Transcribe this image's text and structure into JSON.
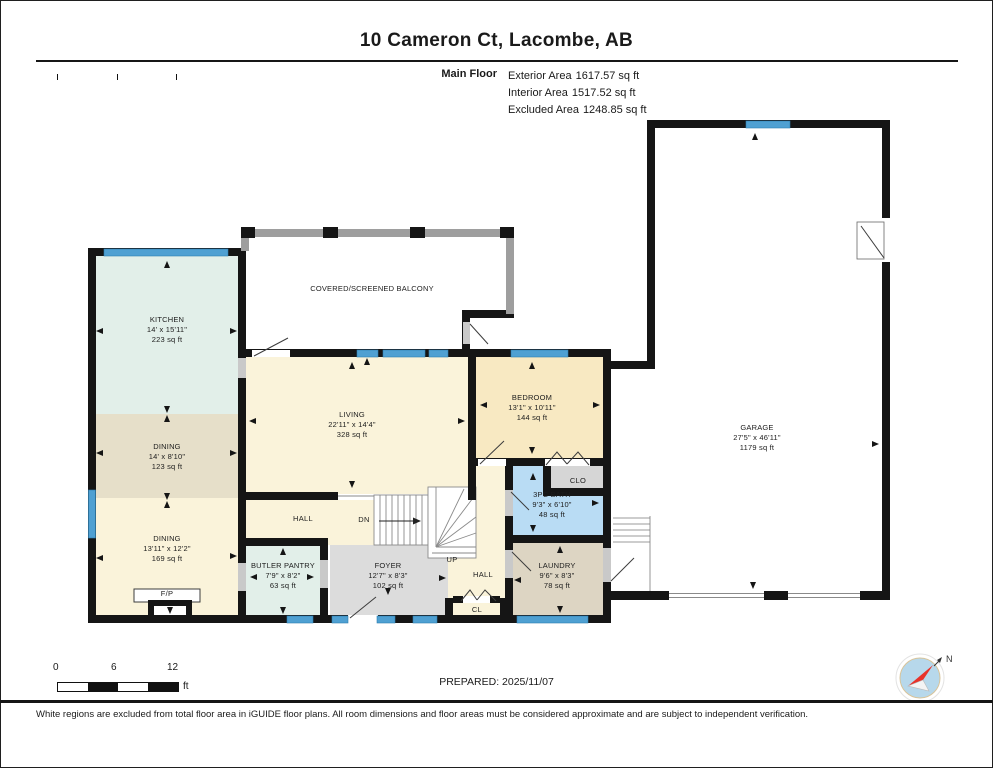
{
  "header": {
    "title": "10 Cameron Ct, Lacombe, AB",
    "floor_label": "Main Floor",
    "areas": [
      {
        "label": "Exterior Area",
        "value": "1617.57 sq ft"
      },
      {
        "label": "Interior Area",
        "value": "1517.52 sq ft"
      },
      {
        "label": "Excluded Area",
        "value": "1248.85 sq ft"
      }
    ]
  },
  "floorplan": {
    "wall_color": "#151515",
    "window_color": "#4fa0d2",
    "rooms": [
      {
        "id": "kitchen",
        "name": "KITCHEN",
        "dims": "14' x 15'11\"",
        "area": "223 sq ft",
        "color": "#e2efe9",
        "rect": [
          94,
          254,
          146,
          162
        ],
        "label_at": [
          167,
          322
        ]
      },
      {
        "id": "dining-upper",
        "name": "DINING",
        "dims": "14' x 8'10\"",
        "area": "123 sq ft",
        "color": "#e6dfc9",
        "rect": [
          94,
          414,
          146,
          88
        ],
        "label_at": [
          167,
          449
        ]
      },
      {
        "id": "dining-lower",
        "name": "DINING",
        "dims": "13'11\" x 12'2\"",
        "area": "169 sq ft",
        "color": "#faf3da",
        "rect": [
          94,
          498,
          146,
          119
        ],
        "label_at": [
          167,
          541
        ]
      },
      {
        "id": "balcony",
        "name": "COVERED/SCREENED BALCONY",
        "dims": "",
        "area": "",
        "color": "#ffffff",
        "rect": [
          247,
          235,
          261,
          116
        ],
        "label_at": [
          372,
          291
        ]
      },
      {
        "id": "living",
        "name": "LIVING",
        "dims": "22'11\" x 14'4\"",
        "area": "328 sq ft",
        "color": "#faf3da",
        "rect": [
          244,
          355,
          226,
          139
        ],
        "label_at": [
          352,
          417
        ]
      },
      {
        "id": "bedroom",
        "name": "BEDROOM",
        "dims": "13'1\" x 10'11\"",
        "area": "144 sq ft",
        "color": "#f8e9c2",
        "rect": [
          474,
          355,
          131,
          105
        ],
        "label_at": [
          532,
          400
        ]
      },
      {
        "id": "hall-upper",
        "name": "",
        "dims": "",
        "area": "",
        "color": "#faf3da",
        "rect": [
          246,
          500,
          182,
          45
        ],
        "label_at": [
          0,
          0
        ]
      },
      {
        "id": "hall-right-a",
        "name": "",
        "dims": "",
        "area": "",
        "color": "#faf3da",
        "rect": [
          476,
          466,
          29,
          149
        ],
        "label_at": [
          0,
          0
        ]
      },
      {
        "id": "hall-right-b",
        "name": "",
        "dims": "",
        "area": "",
        "color": "#faf3da",
        "rect": [
          428,
          500,
          77,
          115
        ],
        "label_at": [
          0,
          0
        ]
      },
      {
        "id": "bath",
        "name": "3PC BATH",
        "dims": "9'3\" x 6'10\"",
        "area": "48 sq ft",
        "color": "#b9dcf4",
        "rect": [
          511,
          464,
          94,
          73
        ],
        "label_at": [
          552,
          497
        ]
      },
      {
        "id": "clo",
        "name": "",
        "dims": "",
        "area": "",
        "color": "#d6d6d6",
        "rect": [
          551,
          466,
          52,
          24
        ],
        "label_at": [
          0,
          0
        ]
      },
      {
        "id": "laundry",
        "name": "LAUNDRY",
        "dims": "9'6\" x 8'3\"",
        "area": "78 sq ft",
        "color": "#ddd5c3",
        "rect": [
          511,
          543,
          92,
          72
        ],
        "label_at": [
          557,
          568
        ]
      },
      {
        "id": "butler-pantry",
        "name": "BUTLER PANTRY",
        "dims": "7'9\" x 8'2\"",
        "area": "63 sq ft",
        "color": "#e2efe9",
        "rect": [
          246,
          541,
          74,
          74
        ],
        "label_at": [
          283,
          568
        ]
      },
      {
        "id": "foyer",
        "name": "FOYER",
        "dims": "12'7\" x 8'3\"",
        "area": "102 sq ft",
        "color": "#dcdcdc",
        "rect": [
          330,
          545,
          118,
          70
        ],
        "label_at": [
          388,
          568
        ]
      },
      {
        "id": "garage",
        "name": "GARAGE",
        "dims": "27'5\" x 46'11\"",
        "area": "1179 sq ft",
        "color": "#ffffff",
        "rect": [
          653,
          126,
          231,
          467
        ],
        "label_at": [
          757,
          430
        ]
      }
    ],
    "small_labels": [
      {
        "id": "hall-1",
        "text": "HALL",
        "at": [
          303,
          521
        ]
      },
      {
        "id": "hall-2",
        "text": "HALL",
        "at": [
          483,
          577
        ]
      },
      {
        "id": "dn",
        "text": "DN",
        "at": [
          364,
          522
        ]
      },
      {
        "id": "up",
        "text": "UP",
        "at": [
          452,
          562
        ]
      },
      {
        "id": "cl",
        "text": "CL",
        "at": [
          477,
          612
        ]
      },
      {
        "id": "clo",
        "text": "CLO",
        "at": [
          578,
          483
        ]
      },
      {
        "id": "fireplace",
        "text": "F/P",
        "at": [
          167,
          596
        ]
      }
    ],
    "arrows": [
      [
        167,
        265,
        "up"
      ],
      [
        100,
        331,
        "left"
      ],
      [
        233,
        331,
        "right"
      ],
      [
        167,
        409,
        "down"
      ],
      [
        167,
        419,
        "up"
      ],
      [
        100,
        453,
        "left"
      ],
      [
        233,
        453,
        "right"
      ],
      [
        167,
        496,
        "down"
      ],
      [
        167,
        505,
        "up"
      ],
      [
        100,
        558,
        "left"
      ],
      [
        233,
        556,
        "right"
      ],
      [
        170,
        610,
        "down"
      ],
      [
        352,
        366,
        "up"
      ],
      [
        253,
        421,
        "left"
      ],
      [
        461,
        421,
        "right"
      ],
      [
        352,
        484,
        "down"
      ],
      [
        367,
        362,
        "up"
      ],
      [
        532,
        366,
        "up"
      ],
      [
        484,
        405,
        "left"
      ],
      [
        596,
        405,
        "right"
      ],
      [
        532,
        450,
        "down"
      ],
      [
        755,
        137,
        "up"
      ],
      [
        875,
        444,
        "right"
      ],
      [
        753,
        585,
        "down"
      ],
      [
        533,
        477,
        "up"
      ],
      [
        533,
        528,
        "down"
      ],
      [
        595,
        503,
        "right"
      ],
      [
        560,
        550,
        "up"
      ],
      [
        518,
        580,
        "left"
      ],
      [
        560,
        609,
        "down"
      ],
      [
        283,
        552,
        "up"
      ],
      [
        254,
        577,
        "left"
      ],
      [
        310,
        577,
        "right"
      ],
      [
        283,
        610,
        "down"
      ],
      [
        388,
        591,
        "down"
      ],
      [
        442,
        578,
        "right"
      ]
    ]
  },
  "footer": {
    "scale": {
      "ticks": [
        "0",
        "6",
        "12"
      ],
      "unit": "ft"
    },
    "prepared": "PREPARED: 2025/11/07",
    "compass_label": "N",
    "disclaimer": "White regions are excluded from total floor area in iGUIDE floor plans. All room dimensions and floor areas must be considered approximate and are subject to independent verification."
  }
}
